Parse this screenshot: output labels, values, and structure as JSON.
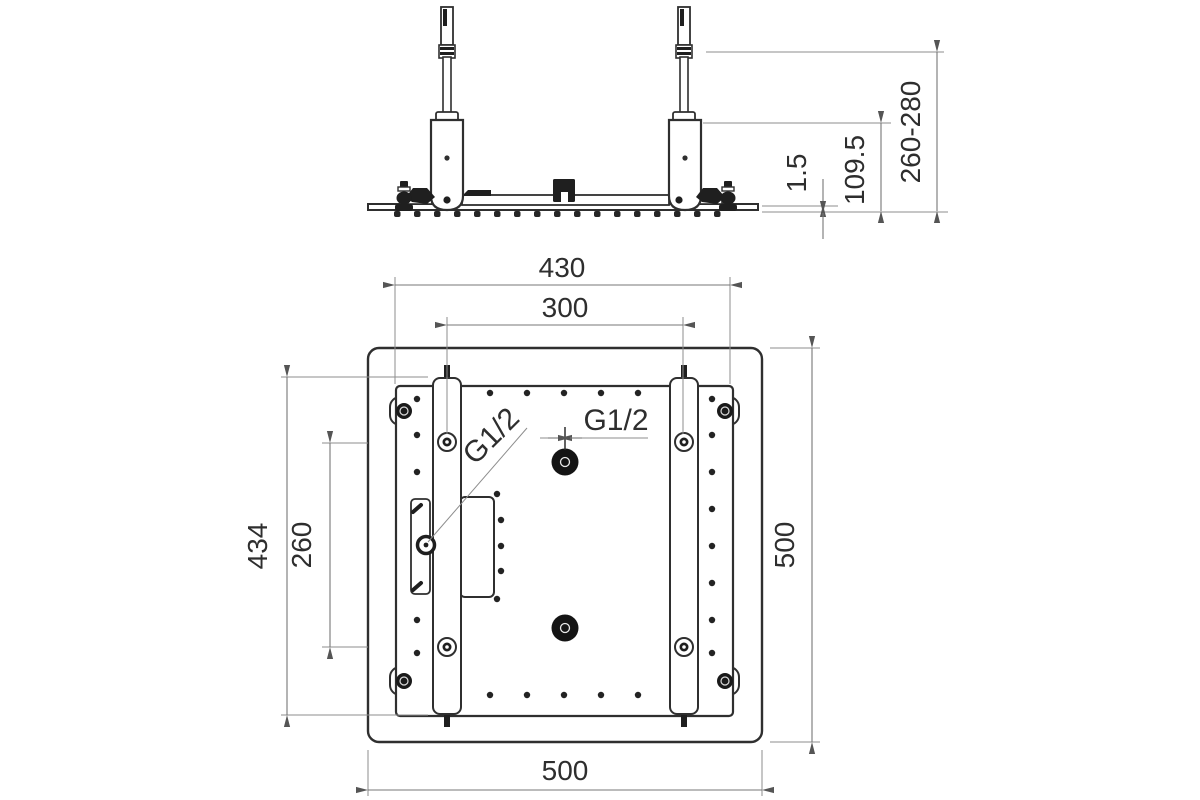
{
  "drawing": {
    "elevation_view": {
      "dims": {
        "height_range": "260-280",
        "body_height": "109.5",
        "plate_thickness": "1.5"
      }
    },
    "plan_view": {
      "dims": {
        "frame_width": "430",
        "rail_spacing": "300",
        "frame_height": "434",
        "hole_spacing": "260",
        "outer_height": "500",
        "outer_width": "500"
      },
      "labels": {
        "inlet_top": "G1/2",
        "inlet_left": "G1/2"
      }
    },
    "colors": {
      "line": "#2f2f2f",
      "dimension": "#777777",
      "background": "#ffffff"
    }
  }
}
